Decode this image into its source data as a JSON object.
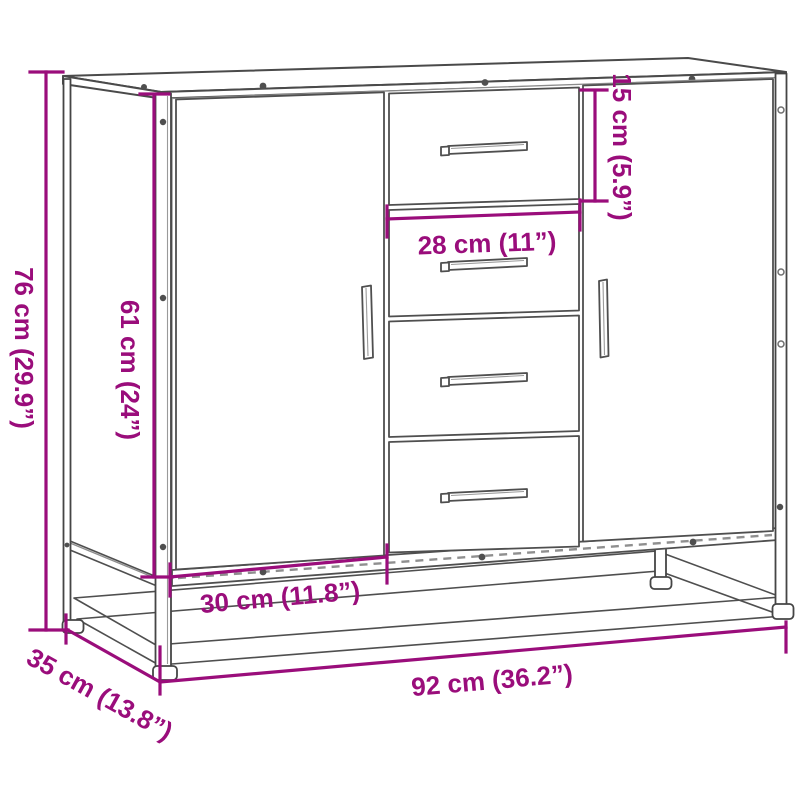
{
  "diagram": {
    "subject": "sideboard-with-2-doors-4-drawers-dimension-drawing",
    "background_color": "#FFFFFF",
    "dimension_color": "#9A0D7B",
    "outline_color": "#4A4A4A",
    "dimensions": {
      "height": "76 cm (29.9”)",
      "door_height": "61 cm (24”)",
      "top_drawer_height": "15 cm (5.9”)",
      "drawer_width": "28 cm (11”)",
      "door_width": "30 cm (11.8”)",
      "depth": "35 cm (13.8”)",
      "width": "92 cm (36.2”)"
    }
  }
}
